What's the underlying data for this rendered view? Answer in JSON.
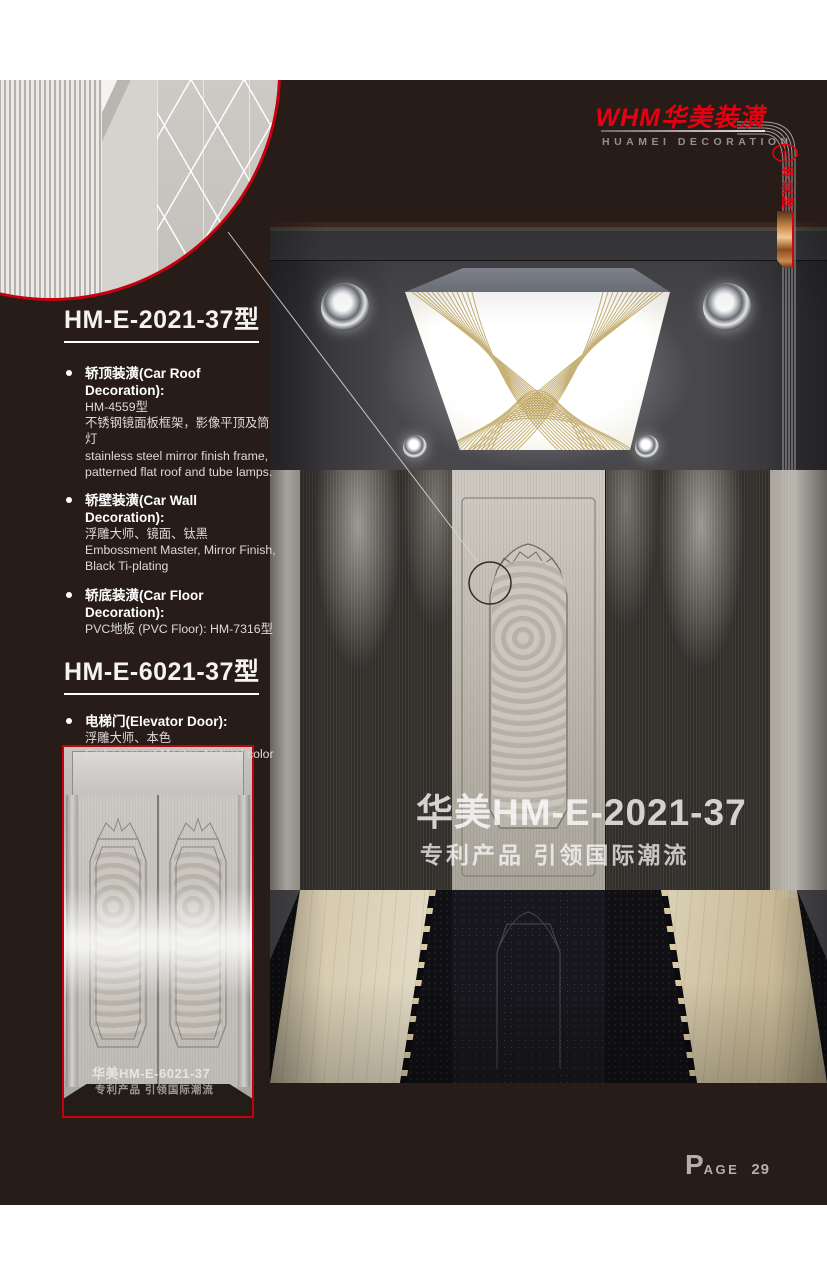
{
  "colors": {
    "accent_red": "#e60012",
    "background_dark": "#271c17",
    "gold_pattern": "#b89d55",
    "copper_ribbon": "#c98b4e",
    "marble_beige": "#e9e2cc",
    "page_text_gray": "#b5afa9"
  },
  "header": {
    "logo_text": "WHM华美装潢",
    "logo_subtext": "HUAMEI DECORATION",
    "side_brand_vertical": "华美牌"
  },
  "sections": [
    {
      "heading": "HM-E-2021-37型",
      "items": [
        {
          "title": "轿顶装潢(Car Roof Decoration):",
          "lines": [
            "HM-4559型",
            "不锈钢镜面板框架，影像平顶及筒灯",
            "stainless steel mirror finish frame,",
            "patterned flat roof and tube lamps."
          ]
        },
        {
          "title": "轿壁装潢(Car Wall Decoration):",
          "lines": [
            "浮雕大师、镜面、钛黑",
            "Embossment Master, Mirror Finish,",
            "Black Ti-plating"
          ]
        },
        {
          "title": "轿底装潢(Car Floor Decoration):",
          "lines": [
            "PVC地板 (PVC Floor): HM-7316型"
          ]
        }
      ]
    },
    {
      "heading": "HM-E-6021-37型",
      "items": [
        {
          "title": "电梯门(Elevator Door):",
          "lines": [
            "浮雕大师、本色",
            "Embossment Master, Natural color"
          ]
        }
      ]
    }
  ],
  "main_image": {
    "watermark_title": "华美HM-E-2021-37",
    "watermark_subtitle": "专利产品 引领国际潮流"
  },
  "door_image": {
    "watermark_title": "华美HM-E-6021-37",
    "watermark_subtitle": "专利产品 引领国际潮流"
  },
  "footer": {
    "page_label_initial": "P",
    "page_label_rest": "AGE",
    "page_number": "29"
  }
}
